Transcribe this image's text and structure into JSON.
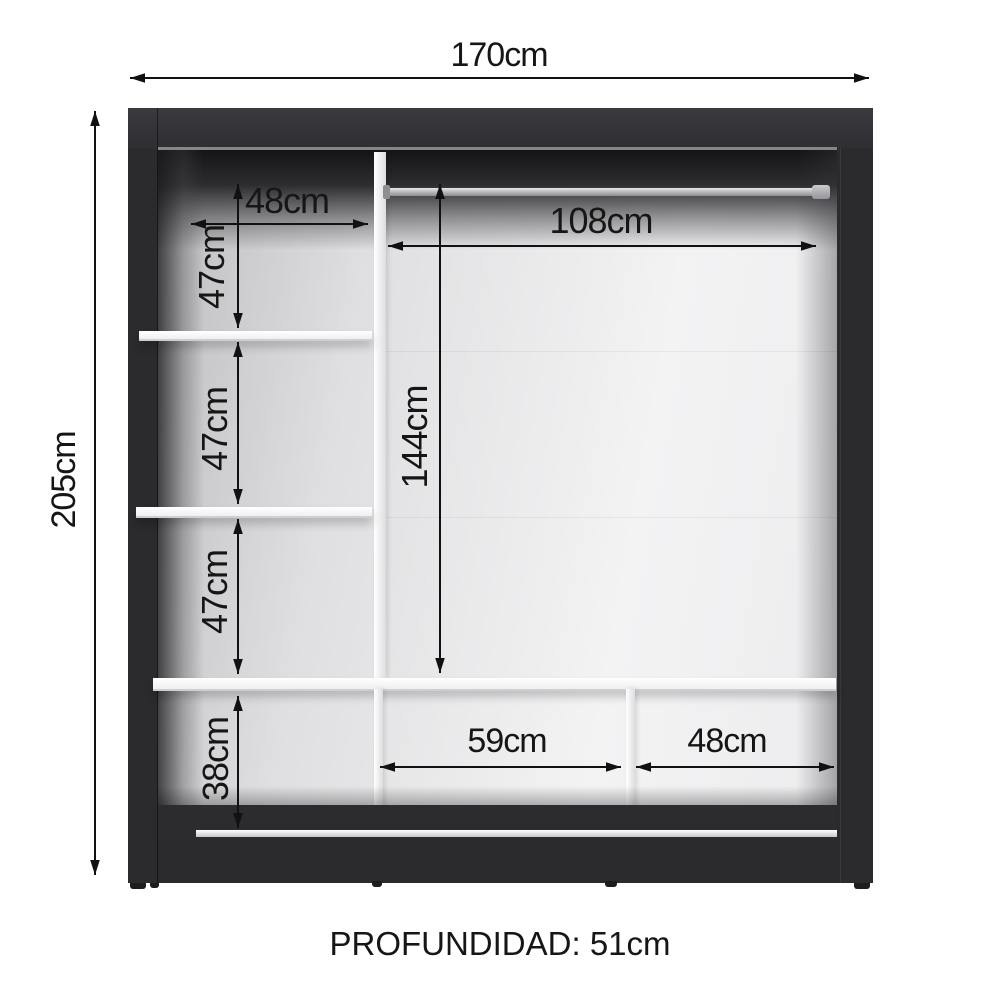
{
  "diagram": {
    "caption": "PROFUNDIDAD: 51cm",
    "dimensions": {
      "total_width": "170cm",
      "total_height": "205cm",
      "top_left_width": "48cm",
      "left_section_1": "47cm",
      "left_section_2": "47cm",
      "left_section_3": "47cm",
      "left_bottom_height": "38cm",
      "rod_width": "108cm",
      "hanging_height": "144cm",
      "bottom_middle_width": "59cm",
      "bottom_right_width": "48cm"
    },
    "colors": {
      "frame": "#2b2b2e",
      "interior_light": "#f3f3f4",
      "rod": "#ababaf",
      "dimension_lines": "#111111"
    }
  }
}
